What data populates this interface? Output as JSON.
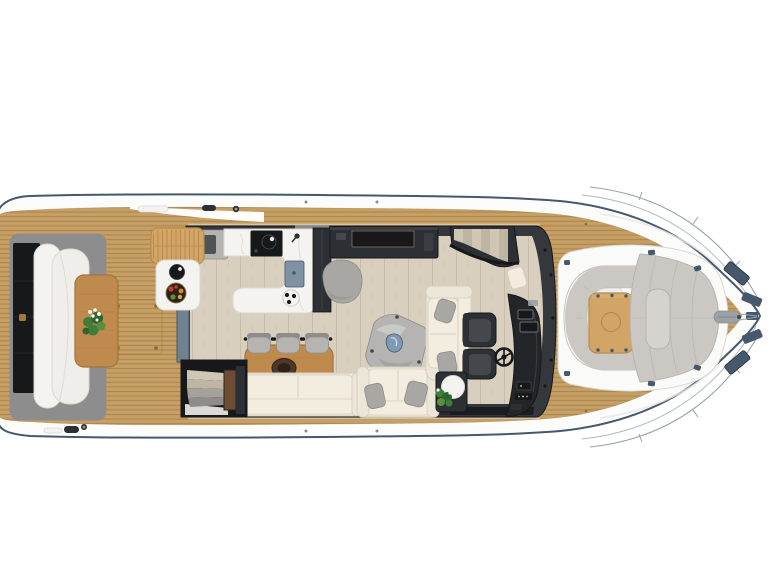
{
  "meta": {
    "title": "Motor yacht main-deck floor plan — top-down 3D render",
    "background": "#ffffff"
  },
  "colors": {
    "white": "#ffffff",
    "hull": "#fcfcfb",
    "navy": "#46586c",
    "railThin": "#98a2ac",
    "teak": "#c49d62",
    "teakLine": "#8f6b3a",
    "teakHi": "#dcb67c",
    "cabin": "#34383c",
    "black": "#16181a",
    "charcoal": "#2c2f33",
    "charcoalHi": "#44484d",
    "floor": "#d8cfbe",
    "floorLine": "#c2b8a3",
    "counter": "#f4f3ef",
    "counterEdge": "#dbd9d2",
    "vein": "#cfcdc5",
    "steel": "#7e92a3",
    "slate": "#70828f",
    "woodMid": "#bf8a4e",
    "woodEdge": "#a1743c",
    "woodLight": "#d2a566",
    "woodLightEdge": "#b68c4d",
    "cream": "#ece6d8",
    "creamHi": "#f3ede0",
    "creamEdge": "#d5cebe",
    "grayPillow": "#a9a7a3",
    "grayMid": "#b6b4b1",
    "grayDark": "#8f8d8a",
    "rug": "#b5b4b2",
    "blue": "#7f9ab4",
    "blueStreak": "#e6ecf2",
    "green": "#3f7d38",
    "greenDark": "#2e6430",
    "flower": "#f3f5f1",
    "tread": "#cfc6b4",
    "treadAlt": "#beb5a2",
    "stepGray": "#a5a29c",
    "helm": "#232629",
    "benchW": "#f4f3f0",
    "whiteSoft": "#efeeea",
    "platform": "#8d8d8d",
    "brass": "#a2793c",
    "podW": "#fafaf8",
    "padGray": "#cbc8c3",
    "padSeam": "#b5b2ac",
    "bolster": "#d6d3ce",
    "metal": "#9aa1a7",
    "brown": "#4f382a",
    "brownDark": "#2e211a",
    "pillar": "#6e4c34",
    "glint": "#e6e8ea",
    "screenRim": "#8a7355",
    "screenEdge": "#878d93",
    "fruitRed": "#c04030",
    "fruitOrange": "#d98a2b",
    "fruitGreen": "#5b8f3e",
    "fruitYellow": "#c9b23e",
    "roofGray": "#9aa0a5",
    "throttleGreen": "#7fc96b"
  },
  "scene": {
    "vessel": "Motor yacht main deck, top view",
    "orientation": "bow to the right, stern to the left",
    "areas": [
      {
        "name": "aft-deck",
        "items": [
          "stern bench",
          "transom hatch",
          "brass latch",
          "teak table with plant",
          "deck hatch",
          "teak decking",
          "boarding pads"
        ]
      },
      {
        "name": "salon",
        "items": [
          "galley counter",
          "cooktop with pot",
          "faucet",
          "sink",
          "burner plate",
          "tall cabinet",
          "wicker bench",
          "outdoor bar table",
          "serving bowl",
          "fruit plate",
          "tv sideboard",
          "gray pouf",
          "dining table with centerpiece",
          "three dining chairs",
          "long sofa",
          "loveseat with pillows",
          "corner sofa with pillows",
          "two dark armchairs",
          "corner side table",
          "side table with round tray and plant",
          "gray rug with throw",
          "aft spiral stairs",
          "companionway stairs",
          "helm console",
          "steering wheel",
          "sliding door"
        ]
      },
      {
        "name": "foredeck",
        "items": [
          "c-shaped bow bench",
          "bow table with cup recess",
          "sunpad with bolster",
          "pod latches",
          "anchor roller",
          "windlass hatches",
          "bow railing",
          "teak decking"
        ]
      }
    ]
  }
}
